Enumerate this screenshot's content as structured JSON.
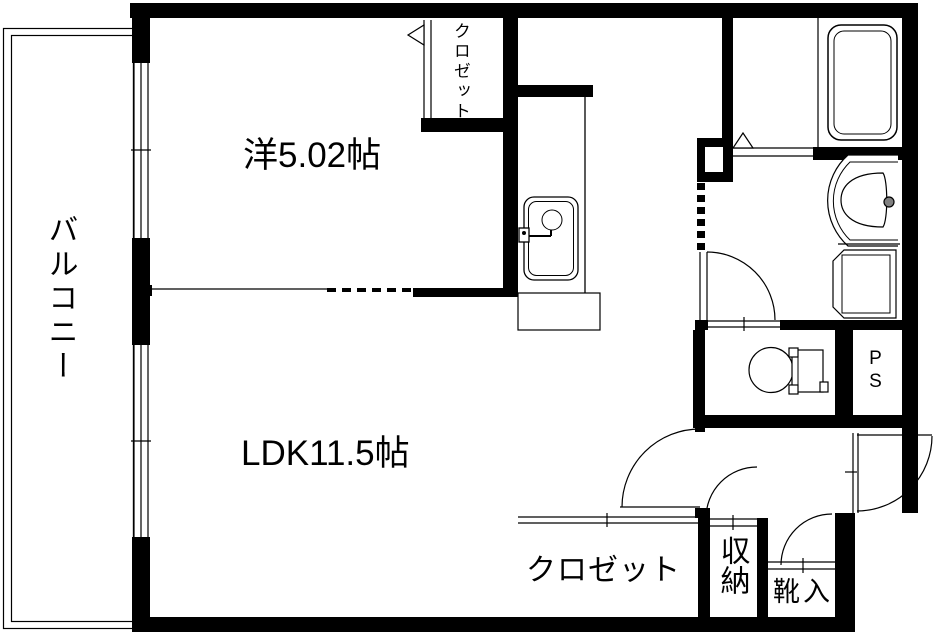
{
  "plan_type": "apartment-floor-plan",
  "rooms": {
    "balcony": "バルコニー",
    "western_room": "洋5.02帖",
    "closet_top": "クロゼット",
    "ldk": "LDK11.5帖",
    "closet_bottom": "クロゼット",
    "storage": "収納",
    "shoe_cabinet": "靴入",
    "pipe_space": "PS"
  },
  "fixtures": [
    "kitchen-sink-icon",
    "kitchen-counter",
    "bathtub-icon",
    "washbasin-icon",
    "washing-machine-pan-icon",
    "toilet-icon",
    "entrance-door-arc",
    "interior-door-arcs",
    "sliding-windows",
    "folding-bath-door"
  ],
  "colors": {
    "wall": "#000000",
    "line": "#000000",
    "background": "#ffffff",
    "faucet_knob": "#808080"
  }
}
